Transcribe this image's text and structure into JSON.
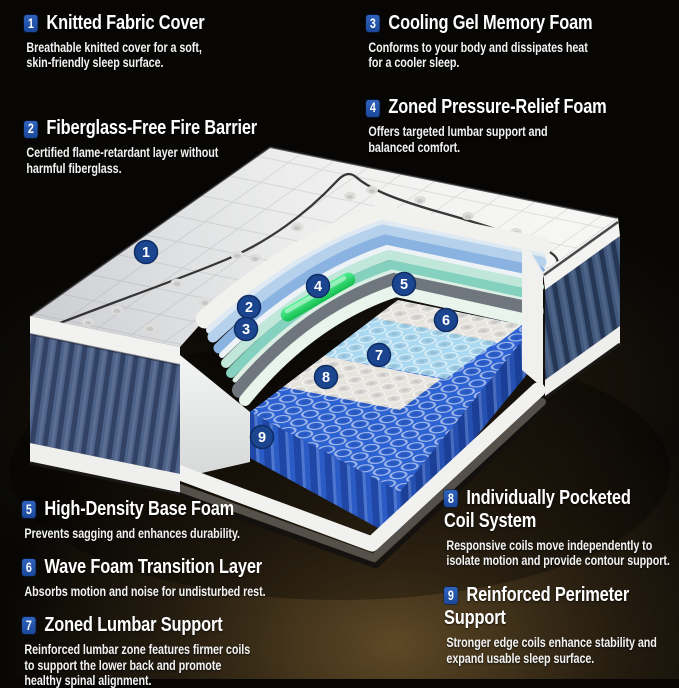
{
  "callouts": {
    "top_left": [
      {
        "num": "1",
        "title": "Knitted Fabric Cover",
        "desc": "Breathable knitted cover for a soft,\nskin-friendly sleep surface."
      },
      {
        "num": "2",
        "title": "Fiberglass-Free Fire Barrier",
        "desc": "Certified flame-retardant layer without\nharmful fiberglass."
      }
    ],
    "top_right": [
      {
        "num": "3",
        "title": "Cooling Gel Memory Foam",
        "desc": "Conforms to your body and dissipates heat\nfor a cooler sleep."
      },
      {
        "num": "4",
        "title": "Zoned Pressure-Relief Foam",
        "desc": "Offers targeted lumbar support and\nbalanced comfort."
      }
    ],
    "bottom_left": [
      {
        "num": "5",
        "title": "High-Density Base Foam",
        "desc": "Prevents sagging and enhances durability."
      },
      {
        "num": "6",
        "title": "Wave Foam Transition Layer",
        "desc": "Absorbs motion and noise for undisturbed rest."
      },
      {
        "num": "7",
        "title": "Zoned Lumbar Support",
        "desc": "Reinforced lumbar zone features firmer coils\nto support the lower back and promote\nhealthy spinal alignment."
      }
    ],
    "bottom_right": [
      {
        "num": "8",
        "title": "Individually Pocketed\nCoil System",
        "desc": "Responsive coils move independently to\nisolate motion and provide contour support."
      },
      {
        "num": "9",
        "title": "Reinforced Perimeter\nSupport",
        "desc": "Stronger edge coils enhance stability and\nexpand usable sleep surface."
      }
    ]
  },
  "diagram": {
    "badges": [
      {
        "num": "1",
        "x": 146,
        "y": 252
      },
      {
        "num": "2",
        "x": 249,
        "y": 307
      },
      {
        "num": "3",
        "x": 246,
        "y": 329
      },
      {
        "num": "4",
        "x": 318,
        "y": 286
      },
      {
        "num": "5",
        "x": 404,
        "y": 284
      },
      {
        "num": "6",
        "x": 446,
        "y": 320
      },
      {
        "num": "7",
        "x": 379,
        "y": 355
      },
      {
        "num": "8",
        "x": 326,
        "y": 377
      },
      {
        "num": "9",
        "x": 262,
        "y": 437
      }
    ],
    "colors": {
      "badge_square": "#2456a8",
      "badge_circle": "#1c4590",
      "quilt_white": "#f5f5f3",
      "memory_foam_blue": "#8ab3e1",
      "comfort_blue": "#b6d1ec",
      "gel_green": "#2ee573",
      "transition_mint": "#c0e7d9",
      "transition_teal": "#85d1bf",
      "base_foam_gray": "#70767d",
      "coil_blue": "#2d62d2",
      "coil_lumbar_blue": "#a9d9f0",
      "coil_white": "#e6e3dc",
      "side_fabric_blue": "#4c6188"
    }
  }
}
